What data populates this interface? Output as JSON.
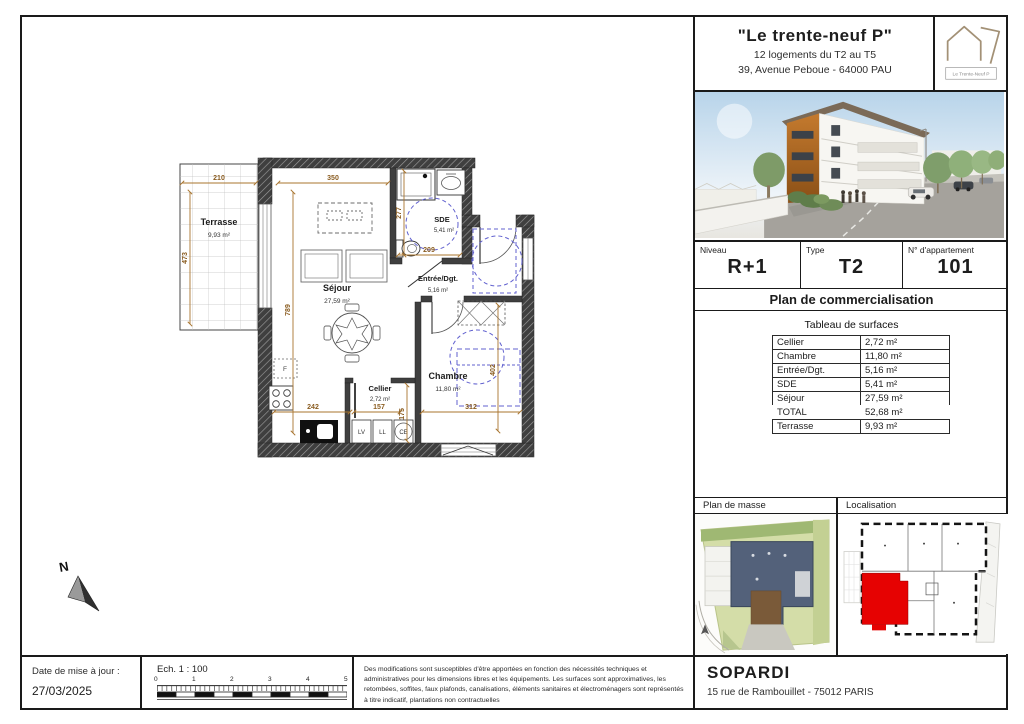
{
  "header": {
    "title": "\"Le trente-neuf P\"",
    "subtitle_line1": "12 logements du T2 au T5",
    "subtitle_line2": "39, Avenue Peboue - 64000 PAU",
    "logo_caption": "Le Trente-Neuf P"
  },
  "info": {
    "niveau_label": "Niveau",
    "niveau_value": "R+1",
    "type_label": "Type",
    "type_value": "T2",
    "apartment_label": "N° d'appartement",
    "apartment_value": "101"
  },
  "plan_title": "Plan de commercialisation",
  "surfaces": {
    "title": "Tableau de surfaces",
    "rows": [
      {
        "label": "Cellier",
        "value": "2,72 m²"
      },
      {
        "label": "Chambre",
        "value": "11,80 m²"
      },
      {
        "label": "Entrée/Dgt.",
        "value": "5,16 m²"
      },
      {
        "label": "SDE",
        "value": "5,41 m²"
      },
      {
        "label": "Séjour",
        "value": "27,59 m²"
      },
      {
        "label": "TOTAL",
        "value": "52,68 m²"
      },
      {
        "label": "Terrasse",
        "value": "9,93 m²"
      }
    ]
  },
  "maps": {
    "left_label": "Plan de masse",
    "right_label": "Localisation"
  },
  "floor_plan": {
    "compass": "N",
    "rooms": [
      {
        "name": "Terrasse",
        "area": "9,93 m²"
      },
      {
        "name": "Séjour",
        "area": "27,59 m²"
      },
      {
        "name": "SDE",
        "area": "5,41 m²"
      },
      {
        "name": "Entrée/Dgt.",
        "area": "5,16 m²"
      },
      {
        "name": "Cellier",
        "area": "2,72 m²"
      },
      {
        "name": "Chambre",
        "area": "11,80 m²"
      }
    ],
    "dims": {
      "terrasse_w": "210",
      "terrasse_h": "473",
      "sejour_w": "350",
      "sejour_h": "789",
      "sde_h": "277",
      "sde_w": "209",
      "kitchen_w": "242",
      "cellier_w": "157",
      "cellier_h": "175",
      "chambre_w": "312",
      "chambre_h": "402"
    },
    "appliances": {
      "fridge": "F",
      "dishwasher": "LV",
      "washer": "LL",
      "water_heater": "CE"
    }
  },
  "footer": {
    "date_label": "Date de mise à jour :",
    "date_value": "27/03/2025",
    "scale_label": "Ech. 1 : 100",
    "scale_ticks": [
      "0",
      "1",
      "2",
      "3",
      "4",
      "5"
    ],
    "disclaimer": "Des modifications sont susceptibles d'être apportées en fonction des nécessités techniques et administratives pour les dimensions libres et les équipements. Les surfaces sont approximatives, les retombées, soffites, faux plafonds, canalisations, éléments sanitaires et électroménagers sont représentés à titre indicatif, plantations non contractuelles",
    "company": "SOPARDI",
    "company_address": "15 rue de Rambouillet - 75012 PARIS"
  },
  "colors": {
    "dimension": "#a8742e",
    "accessibility_circle": "#6161cf",
    "wall": "#3e3e3e",
    "apartment_highlight": "#e60202"
  }
}
